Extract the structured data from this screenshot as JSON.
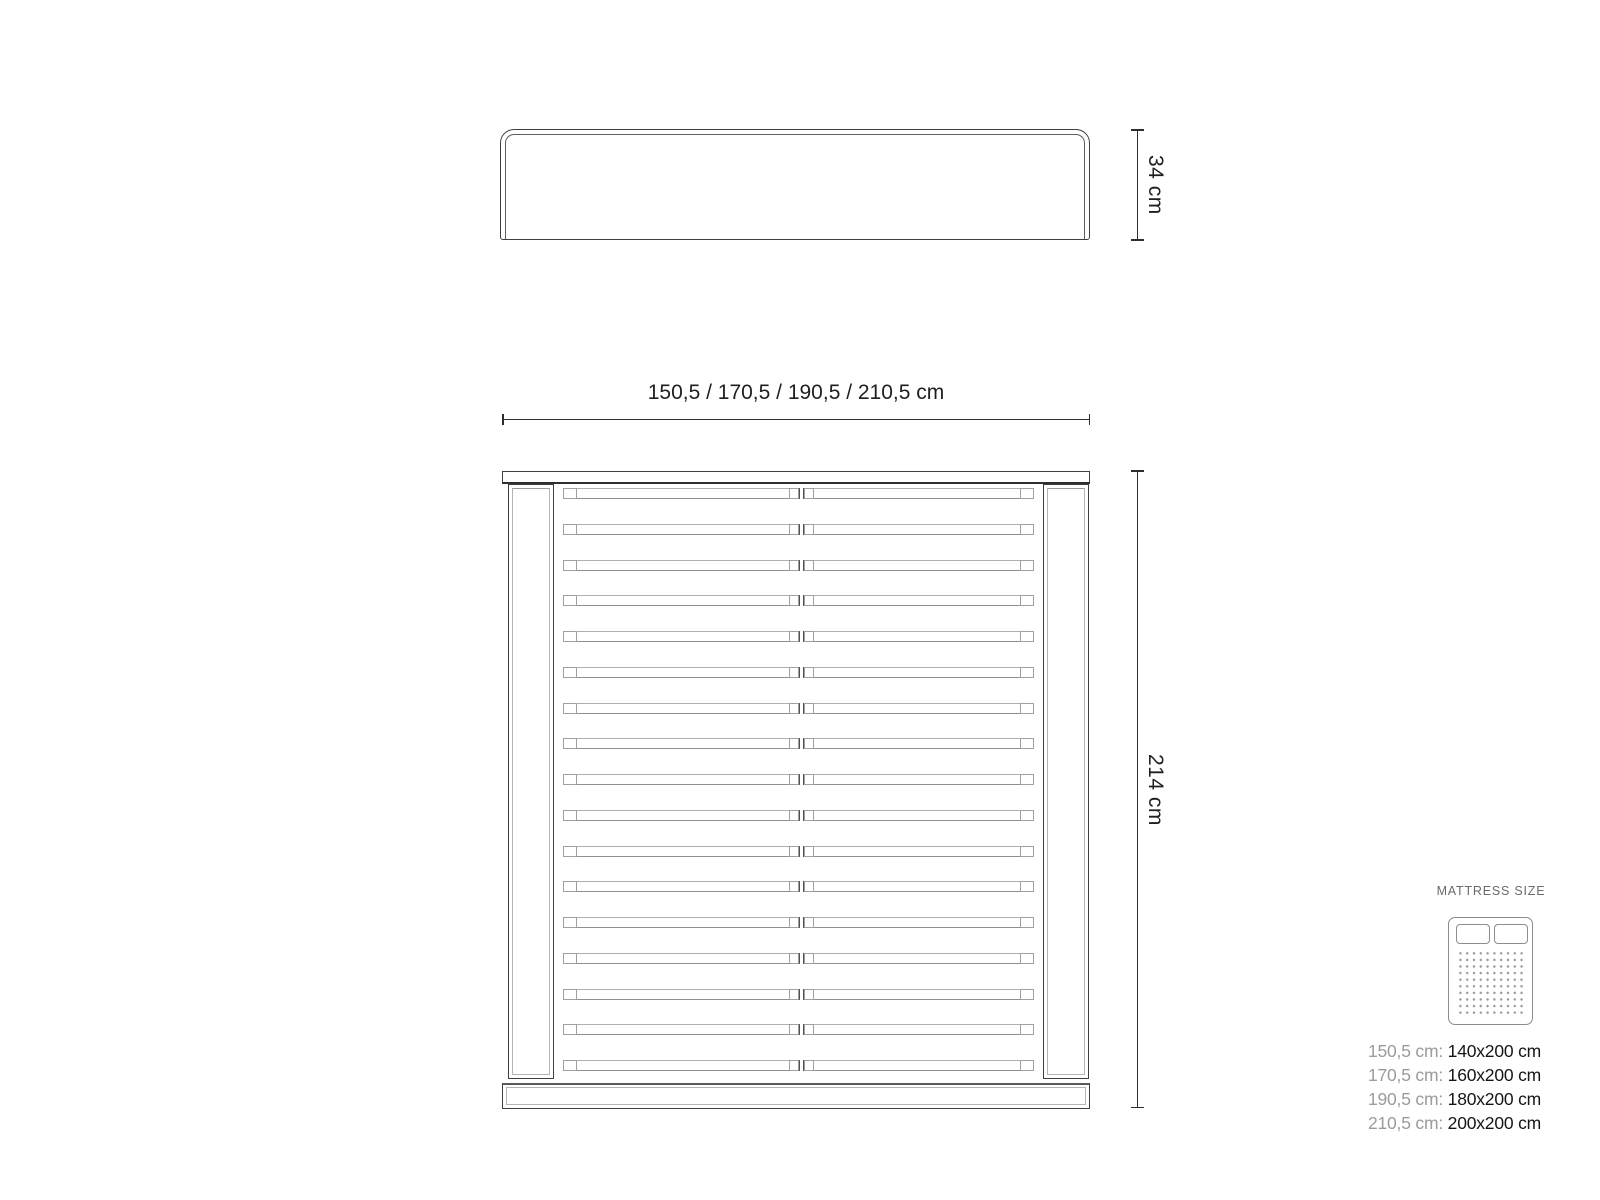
{
  "headboard_view": {
    "height_label": "34 cm"
  },
  "plan_view": {
    "width_label": "150,5 / 170,5 / 190,5 / 210,5 cm",
    "length_label": "214 cm",
    "slat_count": 17
  },
  "mattress_panel": {
    "title": "MATTRESS SIZE",
    "icon": "double-mattress-icon",
    "rows": [
      {
        "frame": "150,5 cm: ",
        "mattress": "140x200 cm"
      },
      {
        "frame": "170,5 cm: ",
        "mattress": "160x200 cm"
      },
      {
        "frame": "190,5 cm: ",
        "mattress": "180x200 cm"
      },
      {
        "frame": "210,5 cm: ",
        "mattress": "200x200 cm"
      }
    ]
  },
  "colors": {
    "outline_dark": "#3f3f3f",
    "outline_gray": "#b0b0b0",
    "dimension_line": "#2e2e2e",
    "text_dark": "#1c1c1c",
    "text_gray": "#9b9b9b",
    "background": "#ffffff"
  }
}
